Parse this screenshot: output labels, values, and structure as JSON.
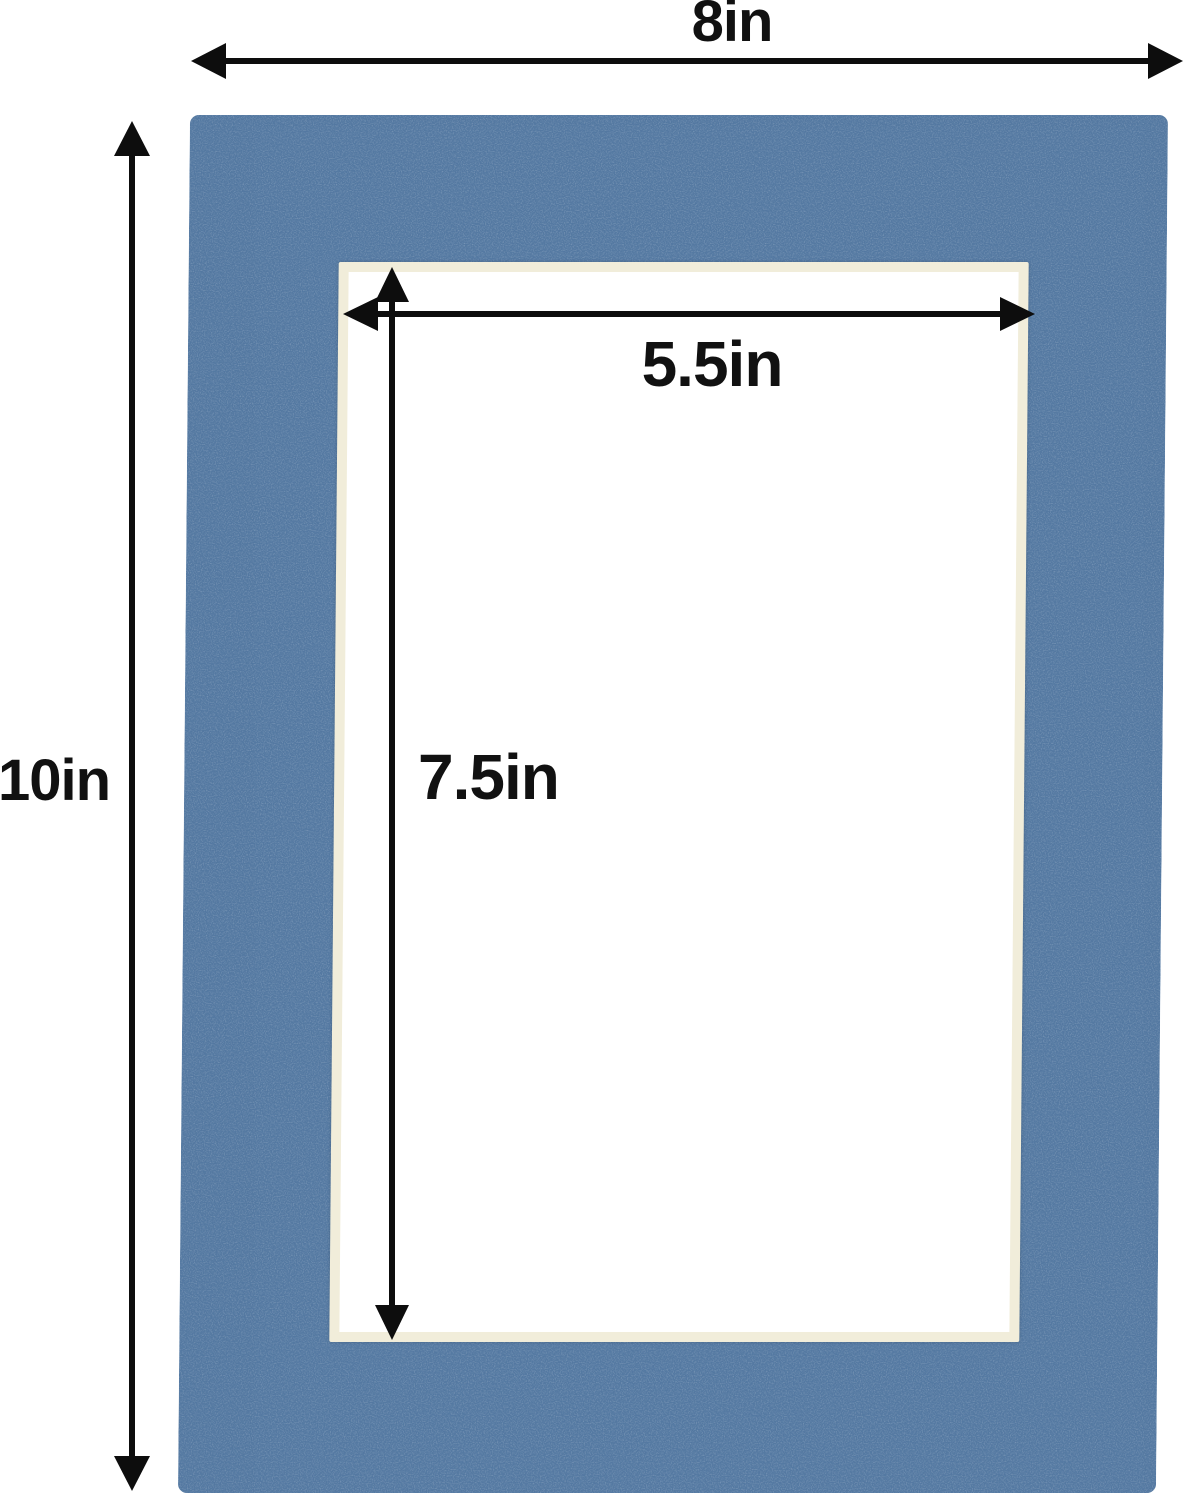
{
  "diagram": {
    "type": "product-dimension-diagram",
    "subject": "Blue picture-frame mat board with rectangular cut opening",
    "labels": {
      "outer_width": "8in",
      "outer_height": "10in",
      "opening_width": "5.5in",
      "opening_height": "7.5in"
    },
    "colors": {
      "mat": "#5479a2",
      "bevel": "#f1edda",
      "opening": "#ffffff",
      "arrow": "#0d0d0d",
      "background": "#ffffff"
    }
  }
}
